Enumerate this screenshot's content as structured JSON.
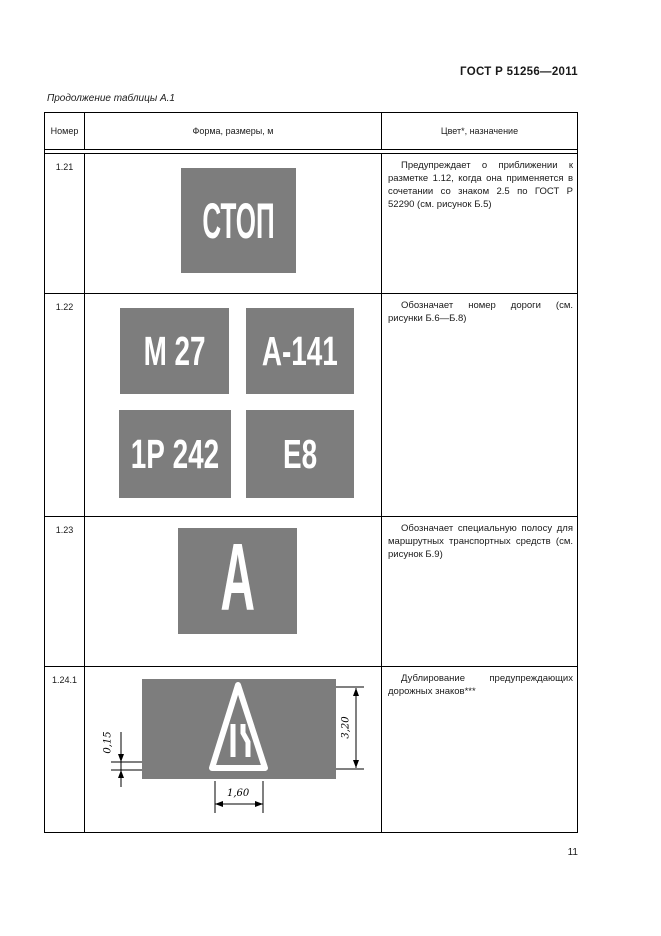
{
  "page": {
    "doc_number": "ГОСТ Р 51256—2011",
    "table_caption": "Продолжение таблицы А.1",
    "page_number": "11"
  },
  "table": {
    "headers": [
      "Номер",
      "Форма, размеры, м",
      "Цвет*, назначение"
    ],
    "rows": [
      {
        "number": "1.21",
        "signs": [
          {
            "label": "СТОП"
          }
        ],
        "description": "Предупреждает о приближении к разметке 1.12, когда она применяется в сочетании со знаком 2.5 по ГОСТ Р 52290 (см. рисунок Б.5)"
      },
      {
        "number": "1.22",
        "signs": [
          {
            "label": "М 27"
          },
          {
            "label": "А-141"
          },
          {
            "label": "1Р 242"
          },
          {
            "label": "Е8"
          }
        ],
        "description": "Обозначает номер дороги (см. рисунки Б.6—Б.8)"
      },
      {
        "number": "1.23",
        "signs": [
          {
            "label": "А"
          }
        ],
        "description": "Обозначает специальную полосу для маршрутных транспортных средств (см. рисунок Б.9)"
      },
      {
        "number": "1.24.1",
        "drawing": {
          "type": "duplicated warning road sign (road narrows) on gray panel",
          "dimensions": {
            "offset": "0,15",
            "height": "3,20",
            "width": "1,60"
          }
        },
        "description": "Дублирование предупреждающих дорожных знаков***"
      }
    ],
    "colors": {
      "sign_gray": "#7d7d7d",
      "sign_text": "#ffffff",
      "line": "#000000"
    }
  }
}
